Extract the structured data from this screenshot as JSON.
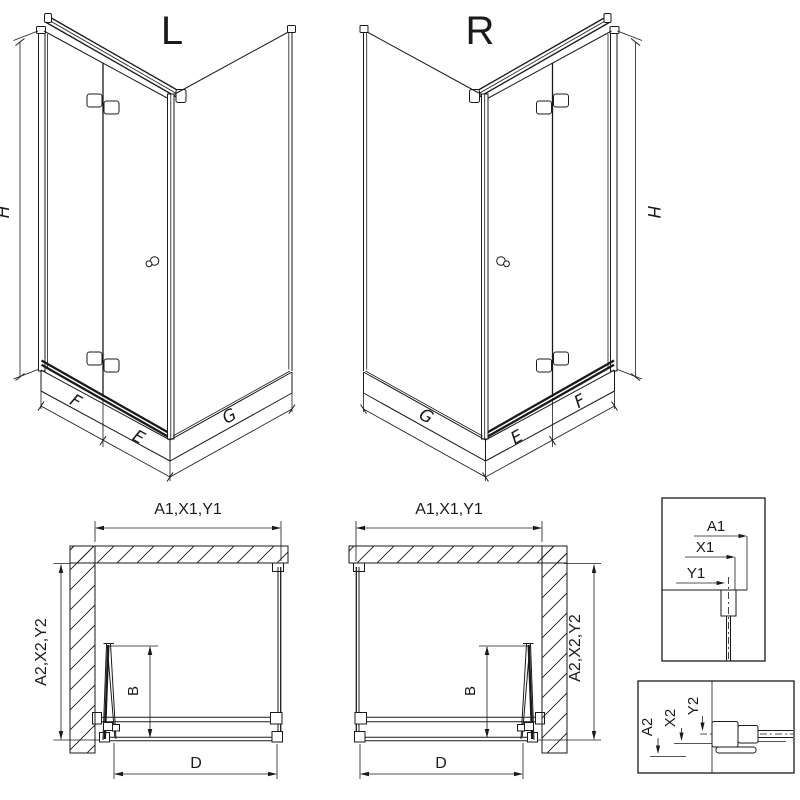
{
  "colors": {
    "ink": "#1a1a1a",
    "background": "#ffffff"
  },
  "iso_left": {
    "title": "L",
    "dim_height": "H",
    "dim_door_panel": "F",
    "dim_door_fixed": "E",
    "dim_side_panel": "G"
  },
  "iso_right": {
    "title": "R",
    "dim_height": "H",
    "dim_door_panel": "F",
    "dim_door_fixed": "E",
    "dim_side_panel": "G"
  },
  "plan_left": {
    "dim_width_top": "A1,X1,Y1",
    "dim_depth_side": "A2,X2,Y2",
    "dim_door_projection": "B",
    "dim_entry_width": "D"
  },
  "plan_right": {
    "dim_width_top": "A1,X1,Y1",
    "dim_depth_side": "A2,X2,Y2",
    "dim_door_projection": "B",
    "dim_entry_width": "D"
  },
  "detail_wall_profile": {
    "dim_a": "A1",
    "dim_x": "X1",
    "dim_y": "Y1"
  },
  "detail_floor_profile": {
    "dim_a": "A2",
    "dim_x": "X2",
    "dim_y": "Y2"
  }
}
